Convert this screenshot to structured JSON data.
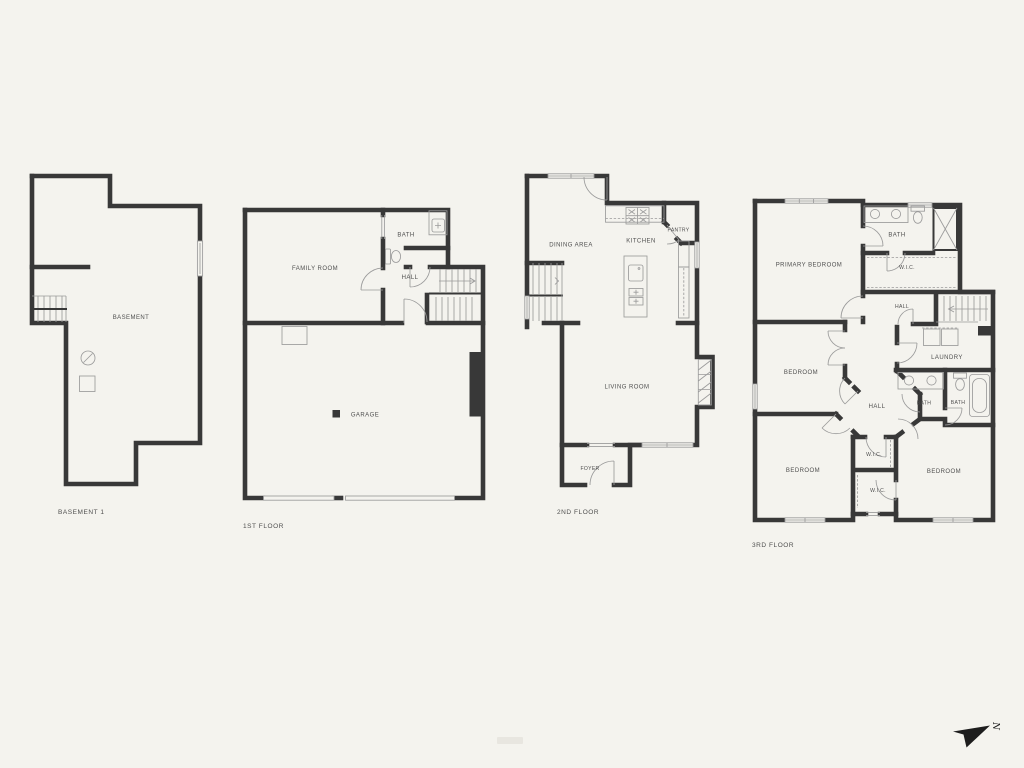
{
  "page": {
    "background": "#f4f3ee",
    "wall_color": "#383838",
    "thin_line_color": "#9b9b9b",
    "text_color": "#4f4f4f",
    "arrow_color": "#1d1d1d"
  },
  "floors": {
    "basement": {
      "name": "BASEMENT 1",
      "rooms": {
        "basement": "BASEMENT"
      }
    },
    "first": {
      "name": "1ST FLOOR",
      "rooms": {
        "family_room": "FAMILY ROOM",
        "bath": "BATH",
        "hall": "HALL",
        "garage": "GARAGE"
      }
    },
    "second": {
      "name": "2ND FLOOR",
      "rooms": {
        "dining": "DINING AREA",
        "kitchen": "KITCHEN",
        "pantry": "PANTRY",
        "living": "LIVING ROOM",
        "foyer": "FOYER"
      }
    },
    "third": {
      "name": "3RD FLOOR",
      "rooms": {
        "primary": "PRIMARY BEDROOM",
        "bath1": "BATH",
        "wic1": "W.I.C.",
        "hall_upper": "HALL",
        "laundry": "LAUNDRY",
        "bedroom2": "BEDROOM",
        "hall_center": "HALL",
        "bath2": "BATH",
        "bath3": "BATH",
        "bedroom3": "BEDROOM",
        "wic2": "W.I.C.",
        "wic3": "W.I.C.",
        "bedroom4": "BEDROOM"
      }
    }
  },
  "compass": {
    "label": "N"
  }
}
